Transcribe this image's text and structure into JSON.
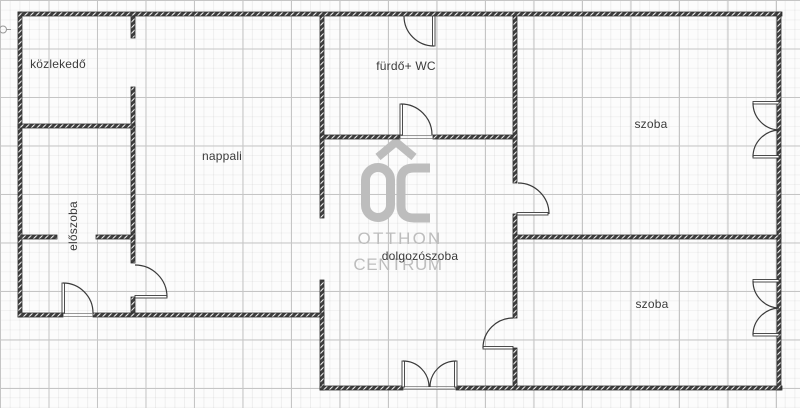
{
  "rooms": {
    "kozlekedo": {
      "label": "közlekedő"
    },
    "nappali": {
      "label": "nappali"
    },
    "furdo_wc": {
      "label": "fürdő+ WC"
    },
    "szoba_felso": {
      "label": "szoba"
    },
    "eloszoba": {
      "label": "előszoba"
    },
    "dolgozoszoba": {
      "label": "dolgozószoba"
    },
    "szoba_also": {
      "label": "szoba"
    }
  },
  "watermark": {
    "logo": "OC",
    "name_line1": "OTTHON",
    "name_line2": "CENTRUM"
  },
  "colors": {
    "wall": "#3e3e3e",
    "line": "#3a3a3a",
    "watermark": "#bdbdbd",
    "grid_major": "#c5c5c5",
    "label": "#3b3b3b",
    "background": "#fcfcfc"
  }
}
